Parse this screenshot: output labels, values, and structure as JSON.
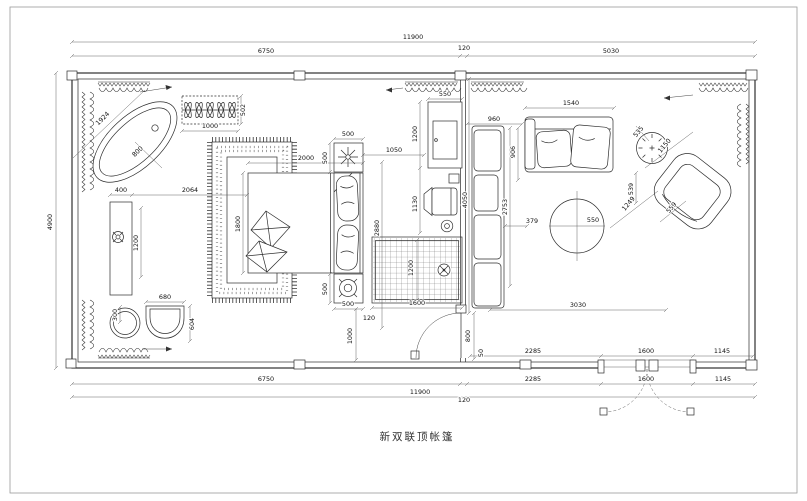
{
  "title": "新双联顶帐篷",
  "dims": {
    "top_total": "11900",
    "top_bedroom": "6750",
    "top_partition": "120",
    "top_living": "5030",
    "left_height": "4900",
    "bot_bedroom": "6750",
    "bot_seg1": "2285",
    "bot_seg2": "1600",
    "bot_seg3": "1145",
    "in_seg1": "2285",
    "in_seg2": "1600",
    "in_seg3": "1145",
    "bot_total": "11900",
    "bot_partition": "120",
    "tub_diag": "1924",
    "tub_radius": "800",
    "planter_w": "1000",
    "planter_d": "502",
    "vanity_w": "400",
    "vanity_gap": "2064",
    "vanity_len": "1200",
    "stool_d": "300",
    "lounge_w": "680",
    "lounge_d": "604",
    "bed_len": "2000",
    "bed_wid": "1800",
    "ns1_w": "500",
    "ns1_d": "500",
    "ns2_d": "500",
    "ns2_w": "500",
    "ns_off": "120",
    "ns_wall": "1000",
    "rug_w": "1600",
    "rug_d": "1200",
    "bed_zone": "2880",
    "bed_tv": "1050",
    "tv_w": "550",
    "tv_d": "1200",
    "chair_d": "1130",
    "sofa_d": "960",
    "sofa_seat": "906",
    "sofa_len": "4050",
    "sofa_run": "2753",
    "sofa_gap": "379",
    "sofa2_w": "1540",
    "table_gap": "539",
    "side_table": "535",
    "coffee_d": "550",
    "arm_w": "1150",
    "arm_diag": "1249",
    "arm_d": "559",
    "living_run": "3030",
    "door_w": "800",
    "door_gap": "50"
  }
}
